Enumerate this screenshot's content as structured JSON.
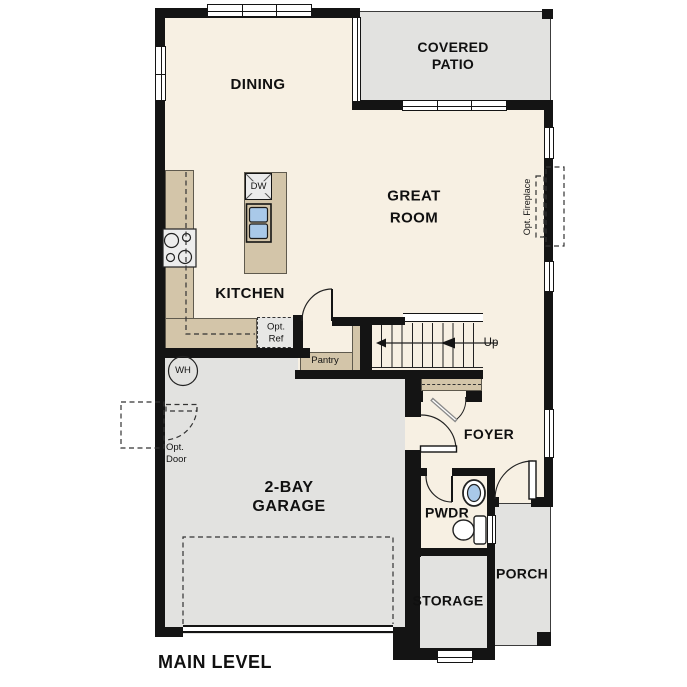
{
  "title": {
    "label": "MAIN LEVEL"
  },
  "rooms": {
    "dining": {
      "label": "DINING"
    },
    "covered_patio": {
      "line1": "COVERED",
      "line2": "PATIO"
    },
    "great_room": {
      "line1": "GREAT",
      "line2": "ROOM"
    },
    "kitchen": {
      "label": "KITCHEN"
    },
    "garage": {
      "line1": "2-BAY",
      "line2": "GARAGE"
    },
    "foyer": {
      "label": "FOYER"
    },
    "pwdr": {
      "label": "PWDR"
    },
    "storage": {
      "label": "STORAGE"
    },
    "porch": {
      "label": "PORCH"
    }
  },
  "features": {
    "pantry": {
      "label": "Pantry"
    },
    "opt_ref": {
      "line1": "Opt.",
      "line2": "Ref"
    },
    "opt_door": {
      "line1": "Opt.",
      "line2": "Door"
    },
    "opt_fireplace": {
      "label": "Opt. Fireplace"
    },
    "water_heater": {
      "label": "WH"
    },
    "dishwasher": {
      "label": "DW"
    },
    "stairs_direction": {
      "label": "Up"
    }
  },
  "colors": {
    "wall": "#141414",
    "floor_living": "#f7f0e3",
    "floor_concrete": "#e2e2e0",
    "counter_tan": "#d3c5a9",
    "fixture_blue": "#a9c9e9"
  }
}
